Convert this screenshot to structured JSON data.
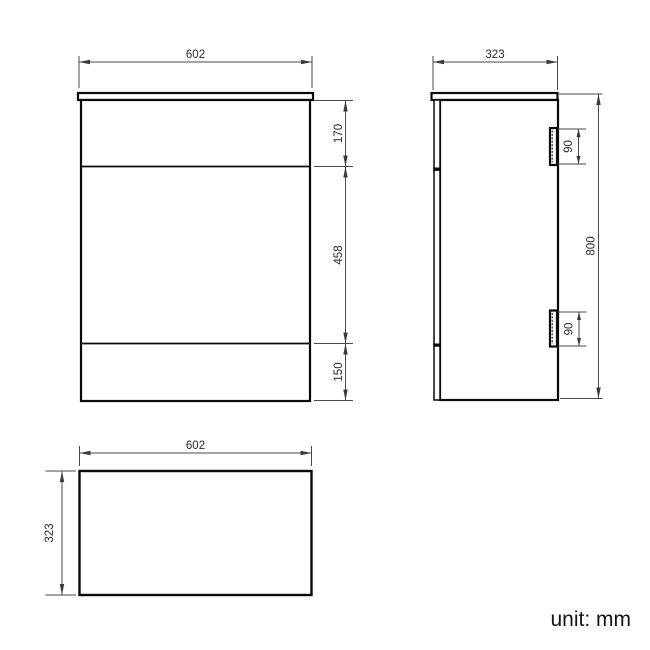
{
  "unit_note": "unit: mm",
  "colors": {
    "background": "#ffffff",
    "object_line": "#0a0a0a",
    "dimension_line": "#4a4a4a",
    "text": "#2b2b2b"
  },
  "views": {
    "front": {
      "width_mm": "602",
      "section_top_mm": "170",
      "section_middle_mm": "458",
      "section_bottom_mm": "150"
    },
    "side": {
      "depth_mm": "323",
      "height_mm": "800",
      "hinge_top_mm": "90",
      "hinge_bottom_mm": "90"
    },
    "plan": {
      "width_mm": "602",
      "depth_mm": "323"
    }
  }
}
